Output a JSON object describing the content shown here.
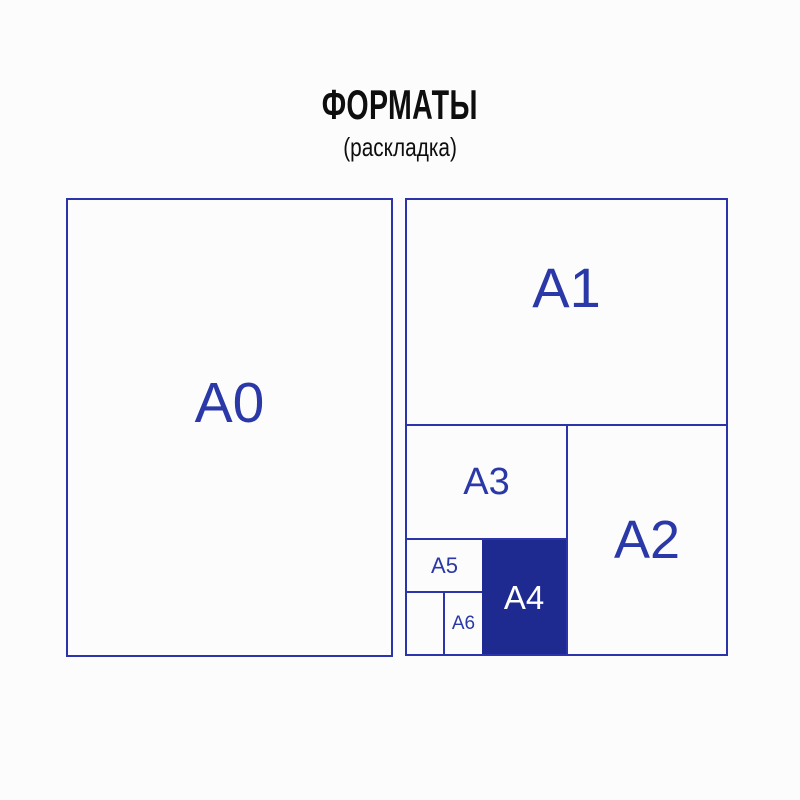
{
  "title": "ФОРМАТЫ",
  "subtitle": "(раскладка)",
  "cells": {
    "a0": "A0",
    "a1": "A1",
    "a2": "A2",
    "a3": "A3",
    "a4": "A4",
    "a5": "A5",
    "a6": "A6"
  },
  "colors": {
    "line": "#2b34ab",
    "label": "#2a38a8",
    "a4_fill": "#1f2a90",
    "a4_label": "#ffffff",
    "title": "#0e0e0e",
    "background": "#fcfcfc"
  }
}
